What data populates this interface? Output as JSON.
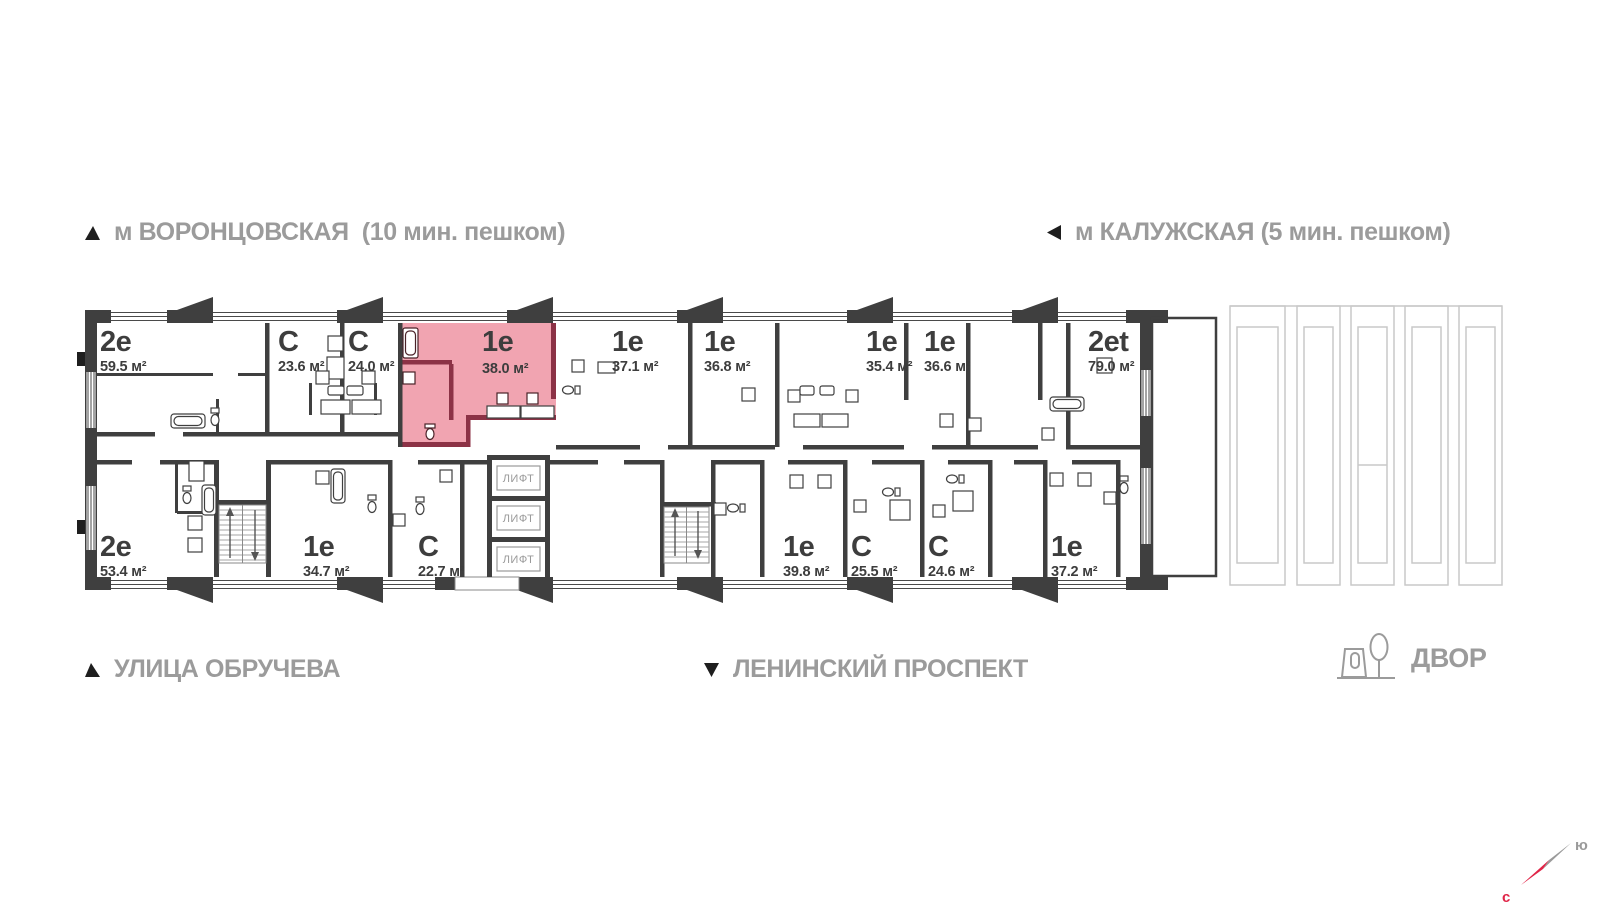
{
  "colors": {
    "wall": "#3f3f3f",
    "highlight_fill": "#f1a4b1",
    "highlight_wall": "#8c3246",
    "outline_gray": "#c9c9c9",
    "label_gray": "#9b9b9b",
    "accent_red": "#e02447"
  },
  "landmarks": {
    "metro_left": "м ВОРОНЦОВСКАЯ  (10 мин. пешком)",
    "metro_right": "м КАЛУЖСКАЯ (5 мин. пешком)",
    "street_bottom_left": "УЛИЦА ОБРУЧЕВА",
    "street_bottom_center": "ЛЕНИНСКИЙ ПРОСПЕКТ",
    "courtyard": "ДВОР",
    "compass_north": "с",
    "compass_south": "ю"
  },
  "plan": {
    "elevator_label": "ЛИФТ",
    "units_top": [
      {
        "type": "2е",
        "area": "59.5 м²"
      },
      {
        "type": "С",
        "area": "23.6 м²"
      },
      {
        "type": "С",
        "area": "24.0 м²"
      },
      {
        "type": "1е",
        "area": "38.0 м²",
        "highlighted": true
      },
      {
        "type": "1е",
        "area": "37.1 м²"
      },
      {
        "type": "1е",
        "area": "36.8 м²"
      },
      {
        "type": "1е",
        "area": "35.4 м²"
      },
      {
        "type": "1е",
        "area": "36.6 м²"
      },
      {
        "type": "2et",
        "area": "79.0 м²"
      }
    ],
    "units_bottom": [
      {
        "type": "2е",
        "area": "53.4 м²"
      },
      {
        "type": "1е",
        "area": "34.7 м²"
      },
      {
        "type": "С",
        "area": "22.7 м²"
      },
      {
        "type": "1е",
        "area": "39.8 м²"
      },
      {
        "type": "С",
        "area": "25.5 м²"
      },
      {
        "type": "С",
        "area": "24.6 м²"
      },
      {
        "type": "1е",
        "area": "37.2 м²"
      }
    ]
  }
}
